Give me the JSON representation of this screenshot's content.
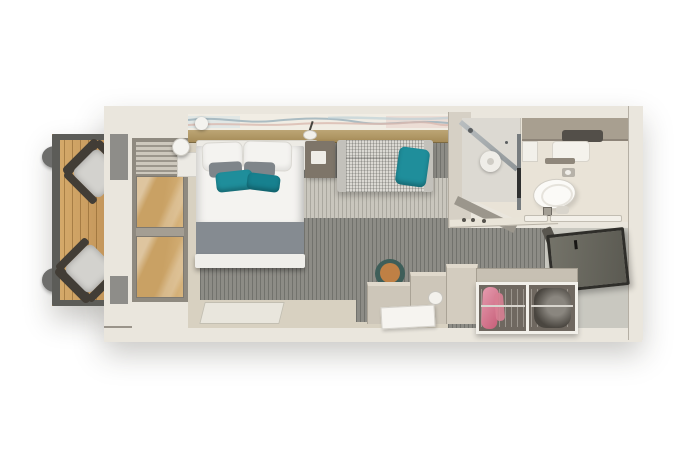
{
  "scene": {
    "name": "balcony-stateroom-floor-plan",
    "view": "top-down 3d render, no visible text",
    "rooms": [
      {
        "id": "balcony",
        "label": "Balcony",
        "items": [
          "deck chair",
          "deck chair",
          "round side table",
          "round side table",
          "wood deck",
          "railing",
          "sliding glass door"
        ]
      },
      {
        "id": "stateroom",
        "label": "Stateroom",
        "items": [
          "double bed",
          "white pillows",
          "gray accent pillows",
          "teal accent pillows",
          "gray bed runner",
          "foot bench",
          "floor mat",
          "bedside shelf",
          "round bedside lamp",
          "nightstand",
          "reading lamp",
          "wavy wall art",
          "wood ledge shelf",
          "tweed sofa",
          "teal throw pillow",
          "stepped desk",
          "round stool",
          "white tray"
        ]
      },
      {
        "id": "bathroom",
        "label": "Bathroom",
        "items": [
          "shower enclosure",
          "shower head",
          "glass partition",
          "toilet",
          "toilet paper holder",
          "vanity counter",
          "dark sink",
          "white basin",
          "towel bars",
          "floor drain"
        ]
      },
      {
        "id": "entry",
        "label": "Entry",
        "items": [
          "open entry door",
          "door handle",
          "angled wall",
          "wardrobe with two sections",
          "pink hanging clothes",
          "dark hanging clothes",
          "cabinet"
        ]
      }
    ]
  },
  "palette": {
    "bg": "#ffffff",
    "wall": "#eae6dd",
    "wallEdge": "#8a8479",
    "railing": "#5c5c58",
    "deck": "#cfa465",
    "sideTable": "#6e6e6c",
    "chairFrame": "#423d36",
    "chairCushion": "#d3d2ce",
    "doorFrame": "#8f8a80",
    "glassWood": "#c9a164",
    "carpetDark": "#8d8c86",
    "carpetLight": "#c9c6bd",
    "walkway": "#d8d1c1",
    "matLight": "#e9e6dd",
    "art": "#f1ede4",
    "artBlue": "#9fb3bc",
    "artPink": "#d9b9af",
    "shelf": "#b39d6e",
    "headboard": "#edebe5",
    "linen": "#f4f3f0",
    "grayPillow": "#7f858a",
    "teal": "#1f8e9b",
    "tealDark": "#17818f",
    "blanket": "#858b91",
    "bench": "#efeeea",
    "nightstand": "#7e7569",
    "sofa": "#dbd9d3",
    "sofaArm": "#c3c1bb",
    "deskFace": "#cdc6b9",
    "deskTop": "#e0d9cc",
    "stoolRim": "#3e5e59",
    "stoolSeat": "#bf8045",
    "dividerWall": "#d6d0c5",
    "bathFloor": "#e9e3d7",
    "showerFloor": "#dcd9d2",
    "counterTaupe": "#a89f90",
    "sinkDark": "#534f49",
    "toiletWhite": "#fbfaf7",
    "fixtureMetal": "#8f9598",
    "towelWhite": "#f3f0e9",
    "vestibule": "#c9c8c0",
    "entryDoor": "#5b5a52",
    "entryDoorEdge": "#2f2e2a",
    "angledWall": "#59564f",
    "closetTop": "#c7c0b3",
    "closetFrame": "#f2f0ea",
    "closetInterior": "#6f6860",
    "pinkGarment": "#c75f79",
    "darkGarment": "#4a4640",
    "rodLight": "#d8d5ce",
    "lampWhite": "#f4f3ef"
  }
}
